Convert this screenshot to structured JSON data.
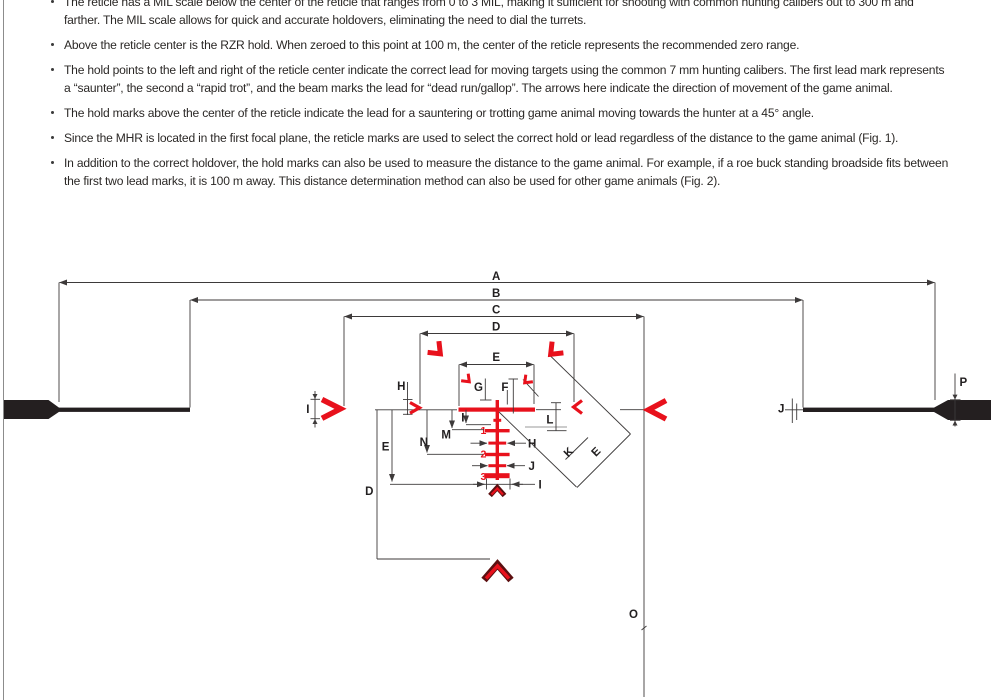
{
  "bullets": [
    {
      "text": "The reticle has a MIL scale below the center of the reticle that ranges from 0 to 3 MIL, making it sufficient for shooting with common hunting calibers out to 300 m and farther. The MIL scale allows for quick and accurate holdovers, eliminating the need to dial the turrets."
    },
    {
      "text": "Above the reticle center is the RZR hold. When zeroed to this point at 100 m, the center of the reticle represents the recommended zero range."
    },
    {
      "text": "The hold points to the left and right of the reticle center indicate the correct lead for moving targets using the common 7 mm hunting calibers. The first lead mark represents a “saunter”, the second a “rapid trot”, and the beam marks the lead for “dead run/gallop”. The arrows here indicate the direction of movement of the game animal."
    },
    {
      "text": "The hold marks above the center of the reticle indicate the lead for a sauntering or trotting game animal moving towards the hunter at a 45° angle."
    },
    {
      "text": "Since the MHR is located in the first focal plane, the reticle marks are used to select the correct hold or lead regardless of the distance to the game animal (Fig. 1)."
    },
    {
      "text": "In addition to the correct holdover, the hold marks can also be used to measure the distance to the game animal. For example, if a roe buck standing broadside fits between the first two lead marks, it is 100 m away. This distance determination method can also be used for other game animals (Fig. 2)."
    }
  ],
  "diagram": {
    "dims": {
      "top_a": "A",
      "top_b": "B",
      "top_c": "C",
      "top_d": "D",
      "top_e": "E",
      "casc_d": "D",
      "casc_e": "E",
      "casc_n": "N",
      "casc_m": "M",
      "casc_i": "I",
      "bottom_i": "I",
      "left_i": "I",
      "left_h": "H",
      "g": "G",
      "f": "F",
      "l": "L",
      "diag_k": "K",
      "diag_e": "E",
      "right_h": "H",
      "right_j": "J",
      "o": "O",
      "bar_j": "J",
      "bar_p": "P"
    },
    "mil_scale": {
      "n1": "1",
      "n2": "2",
      "n3": "3",
      "range_mil": "0 to 3 MIL"
    },
    "colors": {
      "red": "#e8111c",
      "dark_red": "#5c0f10",
      "line": "#3d3a3a",
      "bar": "#241f20",
      "gray": "#9a9a9a",
      "text": "#2b2826"
    }
  }
}
